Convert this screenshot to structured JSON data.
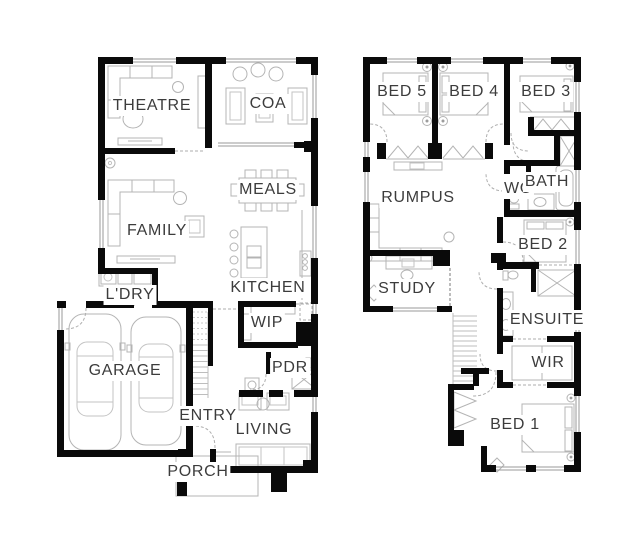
{
  "plan": {
    "floors": {
      "ground": {
        "rooms": [
          {
            "id": "theatre",
            "label": "THEATRE"
          },
          {
            "id": "coa",
            "label": "COA"
          },
          {
            "id": "meals",
            "label": "MEALS"
          },
          {
            "id": "family",
            "label": "FAMILY"
          },
          {
            "id": "kitchen",
            "label": "KITCHEN"
          },
          {
            "id": "ldry",
            "label": "L'DRY"
          },
          {
            "id": "wip",
            "label": "WIP"
          },
          {
            "id": "garage",
            "label": "GARAGE"
          },
          {
            "id": "pdr",
            "label": "PDR"
          },
          {
            "id": "entry",
            "label": "ENTRY"
          },
          {
            "id": "living",
            "label": "LIVING"
          },
          {
            "id": "porch",
            "label": "PORCH"
          }
        ]
      },
      "first": {
        "rooms": [
          {
            "id": "bed5",
            "label": "BED 5"
          },
          {
            "id": "bed4",
            "label": "BED 4"
          },
          {
            "id": "bed3",
            "label": "BED 3"
          },
          {
            "id": "rumpus",
            "label": "RUMPUS"
          },
          {
            "id": "wc",
            "label": "WC"
          },
          {
            "id": "bath",
            "label": "BATH"
          },
          {
            "id": "bed2",
            "label": "BED 2"
          },
          {
            "id": "study",
            "label": "STUDY"
          },
          {
            "id": "ensuite",
            "label": "ENSUITE"
          },
          {
            "id": "wir",
            "label": "WIR"
          },
          {
            "id": "bed1",
            "label": "BED 1"
          }
        ]
      }
    },
    "colors": {
      "wall": "#0a0a0a",
      "furniture": "#b4b4b4",
      "label_text": "#3c3c3c",
      "background": "#ffffff"
    }
  }
}
